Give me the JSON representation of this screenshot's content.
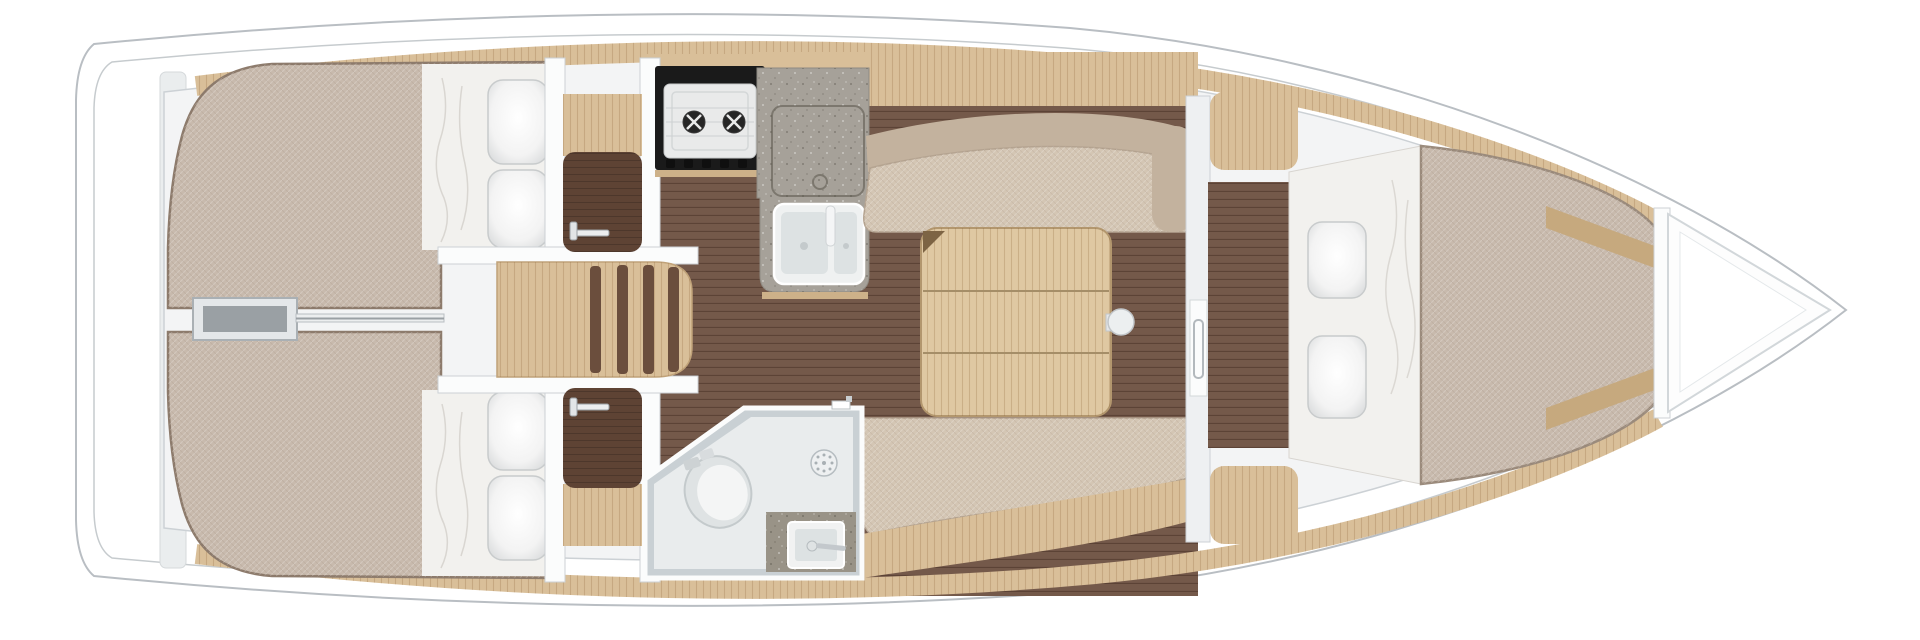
{
  "plan": {
    "title": "Sailboat interior floor plan (overhead view)",
    "view": "top-down",
    "areas": [
      "aft-cabin-port",
      "aft-cabin-starboard",
      "companionway-steps",
      "galley",
      "salon",
      "head-bathroom",
      "forward-cabin",
      "bow-locker"
    ],
    "furniture": [
      "double-berth-port",
      "double-berth-starboard",
      "two-burner-stove",
      "double-galley-sink",
      "fridge-hatch",
      "salon-table",
      "settee-top",
      "settee-bottom",
      "toilet",
      "shower-drain",
      "bathroom-sink",
      "v-berth",
      "cabin-door",
      "nav-shelf",
      "stern-locker-box"
    ]
  },
  "colors": {
    "hull": "#ffffff",
    "outline": "#b9bec3",
    "interior": "#f3f4f5",
    "wall_line": "#ccd1d5",
    "wall_white": "#fbfcfc",
    "wood": "#d9bf99",
    "wood_dark": "#c6a97e",
    "floor": "#74594a",
    "panel_dark": "#5e4334",
    "mattress": "#c8baad",
    "mattress_edge": "#8d7b6c",
    "sheet": "#f2f1ee",
    "pillow": "#f6f6f6",
    "settee": "#d4c6b4",
    "settee_back": "#c3b29e",
    "table": "#dfc8a2",
    "table_edge": "#b3976e",
    "counter": "#a6a199",
    "counter_dark": "#999387",
    "stove_frame": "#1a1a1a",
    "stove_top": "#e9eaea",
    "sink": "#eff1f1",
    "basin": "#dde2e3",
    "bath_wall": "#c9d0d4",
    "bath_floor": "#e9eced",
    "chrome": "#c3c8cc",
    "box_gray": "#9aa0a4"
  }
}
